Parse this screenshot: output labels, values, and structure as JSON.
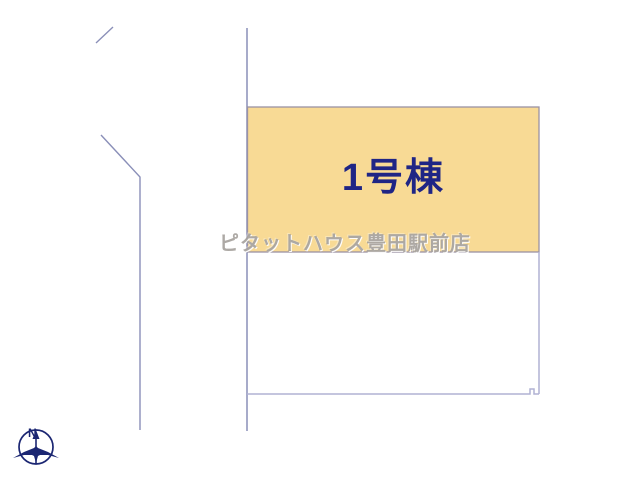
{
  "page": {
    "type": "real-estate-site-plan",
    "background_color": "#ffffff"
  },
  "parcel": {
    "building_label": "1号棟",
    "label_color": "#1f2585",
    "fill_color": "#f8da95",
    "border_color": "#9a92a4"
  },
  "watermark": {
    "text": "ピタットハウス豊田駅前店",
    "color": "#a4a09b"
  },
  "compass": {
    "north_label": "N",
    "color": "#1b2672"
  },
  "boundary_lines": {
    "main_color": "#8a8fb8",
    "light_color": "#b0b2d4"
  }
}
